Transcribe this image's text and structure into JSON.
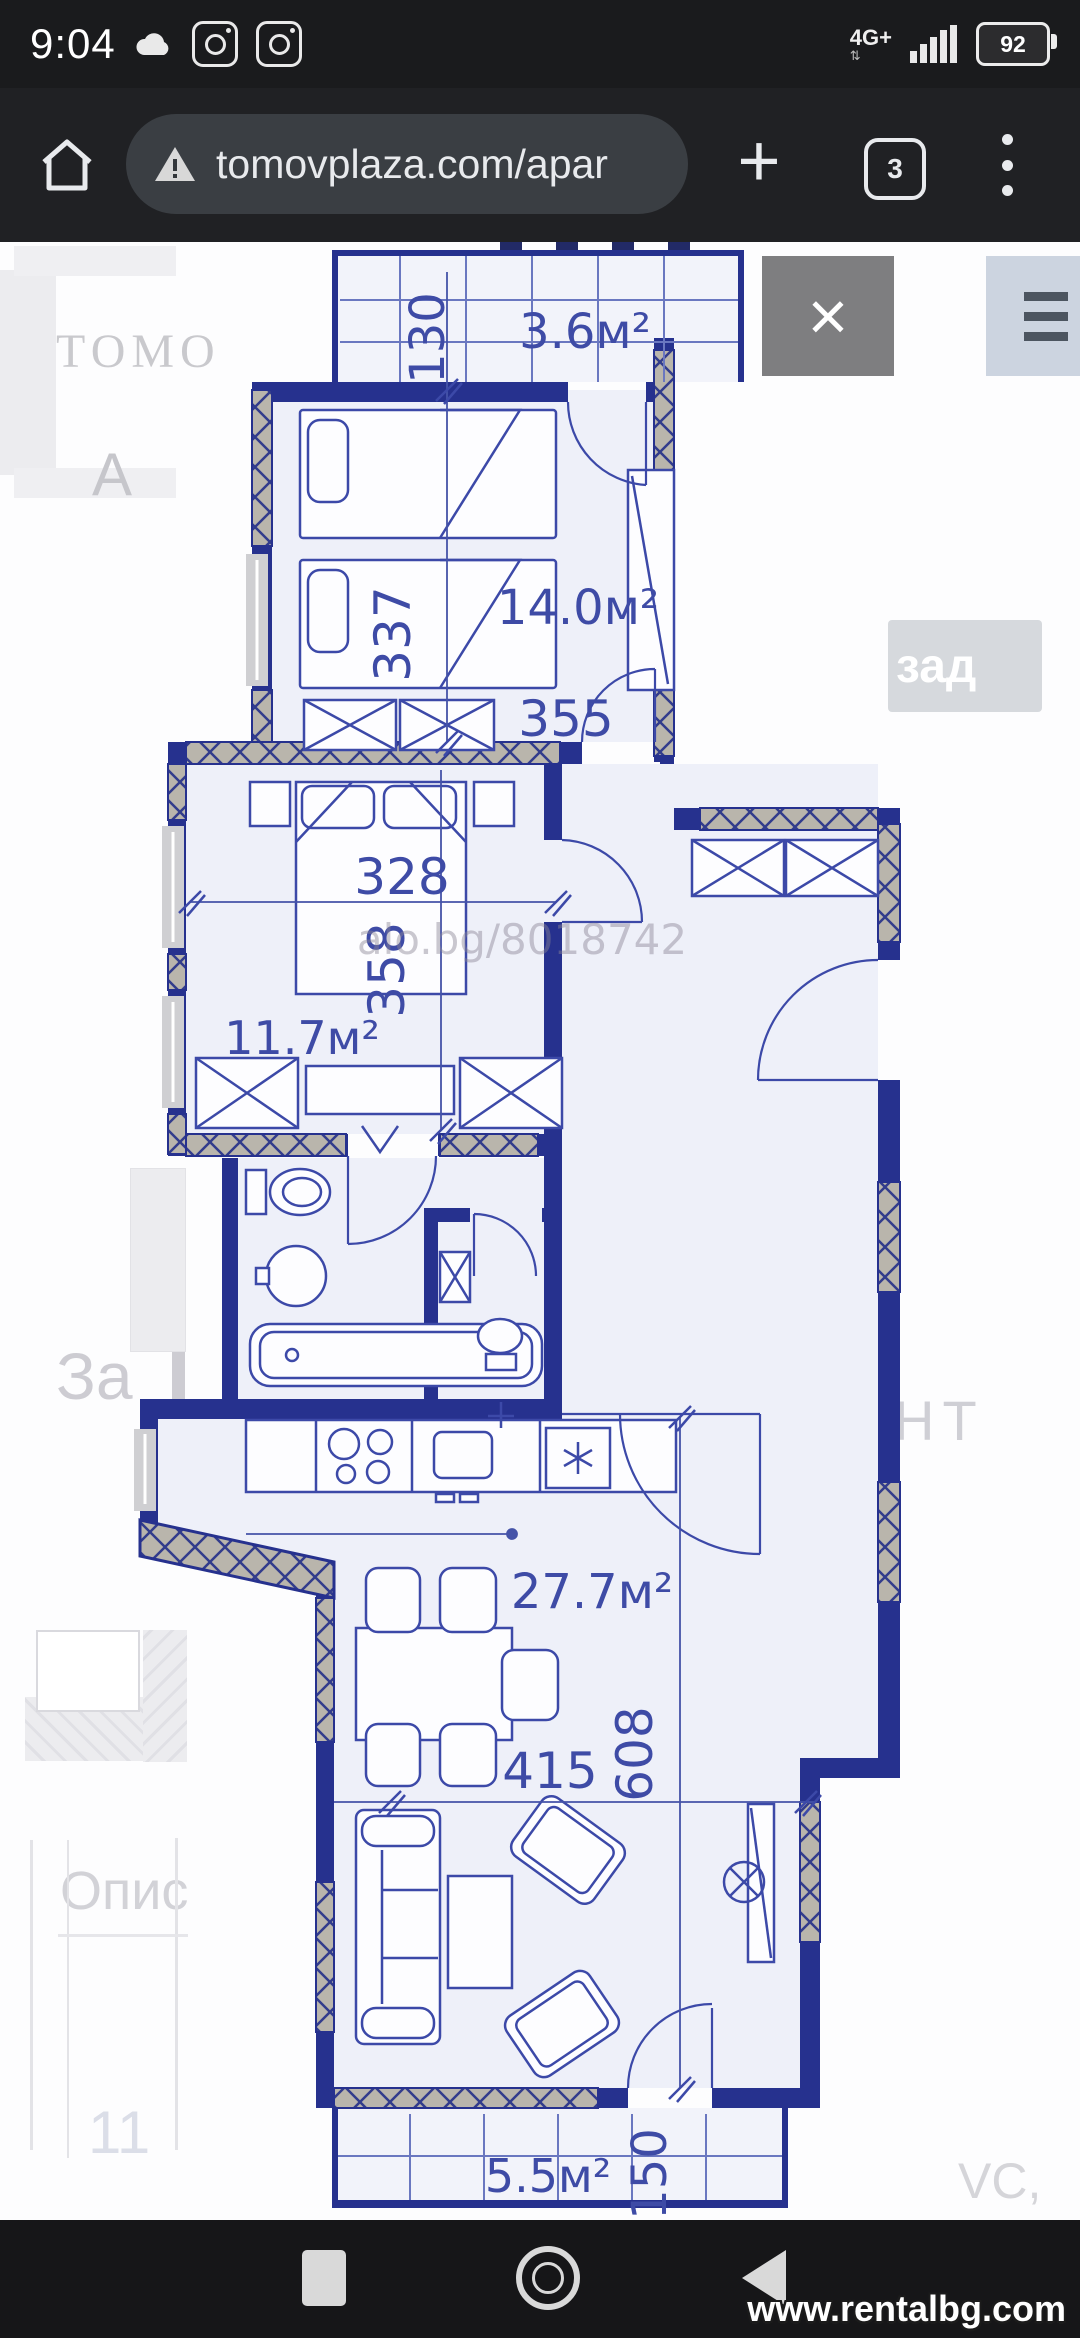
{
  "status_bar": {
    "time": "9:04",
    "network_label": "4G+",
    "battery_level": "92"
  },
  "browser": {
    "url": "tomovplaza.com/apar",
    "tab_count": "3"
  },
  "overlay": {
    "close_label": "×",
    "back_button_label": "зад"
  },
  "background_page": {
    "logo": "ТОМО",
    "letter_left": "А",
    "letter_right": "С",
    "text_mid_left": "За",
    "text_lower_left": "Опис",
    "text_bottom_left": "11",
    "text_mid_right": "НТ",
    "text_bottom_right": "VC,"
  },
  "floor_plan": {
    "watermark": "alo.bg/8018742",
    "rooms": {
      "balcony_top": {
        "area": "3.6м²",
        "dim_width": "130"
      },
      "bedroom_large": {
        "area": "14.0м²",
        "dim_width": "355",
        "dim_depth": "337"
      },
      "bedroom_small": {
        "area": "11.7м²",
        "dim_width": "328",
        "dim_depth": "358"
      },
      "living_kitchen": {
        "area": "27.7м²",
        "dim_width": "415",
        "dim_depth": "608"
      },
      "balcony_bottom": {
        "area": "5.5м²",
        "dim_width": "150"
      }
    }
  },
  "footer_watermark": "www.rentalbg.com",
  "colors": {
    "wall": "#26318e",
    "plan_line": "#3c49a8",
    "hatch_fill": "#b9b5ac",
    "toolbar_bg": "#202124"
  }
}
